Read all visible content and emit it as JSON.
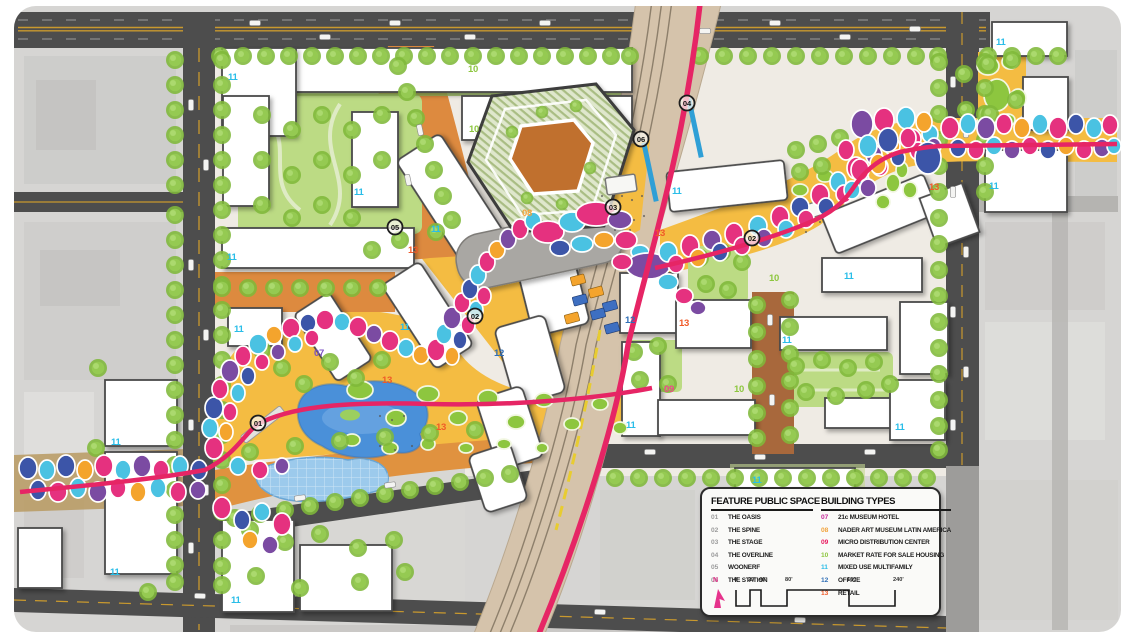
{
  "legend": {
    "feature_title": "FEATURE PUBLIC SPACE",
    "building_title": "BUILDING TYPES",
    "features": [
      {
        "num": "01",
        "label": "THE OASIS"
      },
      {
        "num": "02",
        "label": "THE SPINE"
      },
      {
        "num": "03",
        "label": "THE STAGE"
      },
      {
        "num": "04",
        "label": "THE OVERLINE"
      },
      {
        "num": "05",
        "label": "WOONERF"
      },
      {
        "num": "06",
        "label": "THE STATION"
      }
    ],
    "building_types": [
      {
        "num": "07",
        "label": "21c MUSEUM HOTEL",
        "color": "#c5299b"
      },
      {
        "num": "08",
        "label": "NADER ART MUSEUM LATIN AMERICA",
        "color": "#f2a33c"
      },
      {
        "num": "09",
        "label": "MICRO DISTRIBUTION CENTER",
        "color": "#e8175d"
      },
      {
        "num": "10",
        "label": "MARKET RATE FOR SALE HOUSING",
        "color": "#8dc63f"
      },
      {
        "num": "11",
        "label": "MIXED USE MULTIFAMILY",
        "color": "#29bde8"
      },
      {
        "num": "12",
        "label": "OFFICE",
        "color": "#2f6eb6"
      },
      {
        "num": "13",
        "label": "RETAIL",
        "color": "#f05a28"
      }
    ],
    "north_label": "N",
    "scale_ticks": [
      "0'",
      "20'",
      "40'",
      "80'",
      "160'",
      "240'"
    ]
  },
  "map": {
    "markers": [
      {
        "num": "01"
      },
      {
        "num": "02"
      },
      {
        "num": "02"
      },
      {
        "num": "03"
      },
      {
        "num": "04"
      },
      {
        "num": "05"
      },
      {
        "num": "06"
      }
    ],
    "labels": [
      {
        "text": "11"
      },
      {
        "text": "11"
      },
      {
        "text": "11"
      },
      {
        "text": "10"
      },
      {
        "text": "10"
      },
      {
        "text": "08"
      },
      {
        "text": "11"
      },
      {
        "text": "13"
      },
      {
        "text": "13"
      },
      {
        "text": "11"
      },
      {
        "text": "11"
      },
      {
        "text": "12"
      },
      {
        "text": "13"
      },
      {
        "text": "07"
      },
      {
        "text": "11"
      },
      {
        "text": "11"
      },
      {
        "text": "11"
      },
      {
        "text": "11"
      },
      {
        "text": "13"
      },
      {
        "text": "12"
      },
      {
        "text": "13"
      },
      {
        "text": "09"
      },
      {
        "text": "10"
      },
      {
        "text": "11"
      },
      {
        "text": "11"
      },
      {
        "text": "10"
      },
      {
        "text": "11"
      },
      {
        "text": "11"
      },
      {
        "text": "11"
      },
      {
        "text": "13"
      },
      {
        "text": "11"
      },
      {
        "text": "11"
      }
    ]
  },
  "colors": {
    "c01_06": "#9b9b9b",
    "c07": "#c5299b",
    "c08": "#f2a33c",
    "c09": "#e8175d",
    "c10": "#8dc63f",
    "c11": "#29bde8",
    "c12": "#2f6eb6",
    "c13": "#f05a28",
    "c07_map": "#7b52c4",
    "c09_map": "#f0478c",
    "magenta": "#e5317f",
    "crimson": "#d6176b",
    "cyan": "#4ac2e2",
    "purple": "#7b4ba2",
    "blue": "#3c55a8",
    "amber": "#f4a42d",
    "green": "#8dc63f",
    "ground_yellow": "#f4bc42",
    "ground_orange": "#e0923f",
    "woonerf_brown": "#a8683c",
    "tree_green": "#8cc63e",
    "court_green": "#bcdb84",
    "context_gray": "#d6d5d3",
    "street_gray": "#4d4d4d",
    "rail_tan": "#d5c3ab",
    "overline_pink": "#e62565",
    "pond_blue": "#4a90d9",
    "pond_light": "#9ccaec",
    "north_pink": "#e6338c"
  }
}
